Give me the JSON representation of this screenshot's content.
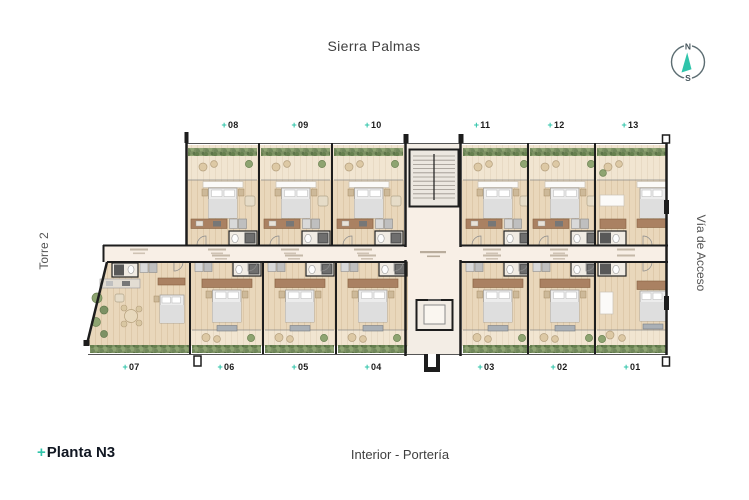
{
  "header": {
    "title": "Sierra Palmas"
  },
  "compass": {
    "north_label": "N",
    "south_label": "S"
  },
  "side_labels": {
    "left": "Torre 2",
    "right": "Vía de Acceso"
  },
  "footer": {
    "floor_marker": "+",
    "floor_label": "Planta N3",
    "center_label": "Interior - Portería"
  },
  "unit_marker": "+",
  "units": {
    "top_row": [
      "08",
      "09",
      "10",
      "11",
      "12",
      "13"
    ],
    "bottom_row": [
      "07",
      "06",
      "05",
      "04",
      "03",
      "02",
      "01"
    ]
  },
  "colors": {
    "accent_teal": "#2fc4aa",
    "wall_black": "#1d1d1d",
    "floor_wood": "#e9d7bb",
    "balcony_floor": "#f1e5d1",
    "corridor_floor": "#f8efe6",
    "hedge_green": "#7d9164",
    "kitchen_brown": "#aa8162"
  }
}
